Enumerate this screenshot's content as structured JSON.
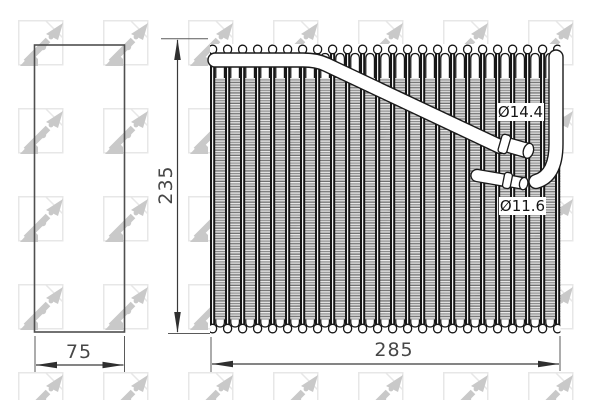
{
  "drawing": {
    "watermark_brand": "NRF",
    "side_view": {
      "width_label": "75"
    },
    "front_view": {
      "height_label": "235",
      "width_label": "285"
    },
    "ports": {
      "large_diameter_label": "Ø14.4",
      "small_diameter_label": "Ø11.6"
    }
  },
  "colors": {
    "line": "#1a1a1a",
    "dimension": "#474747",
    "watermark": "#c9c9c9",
    "background": "#ffffff"
  }
}
